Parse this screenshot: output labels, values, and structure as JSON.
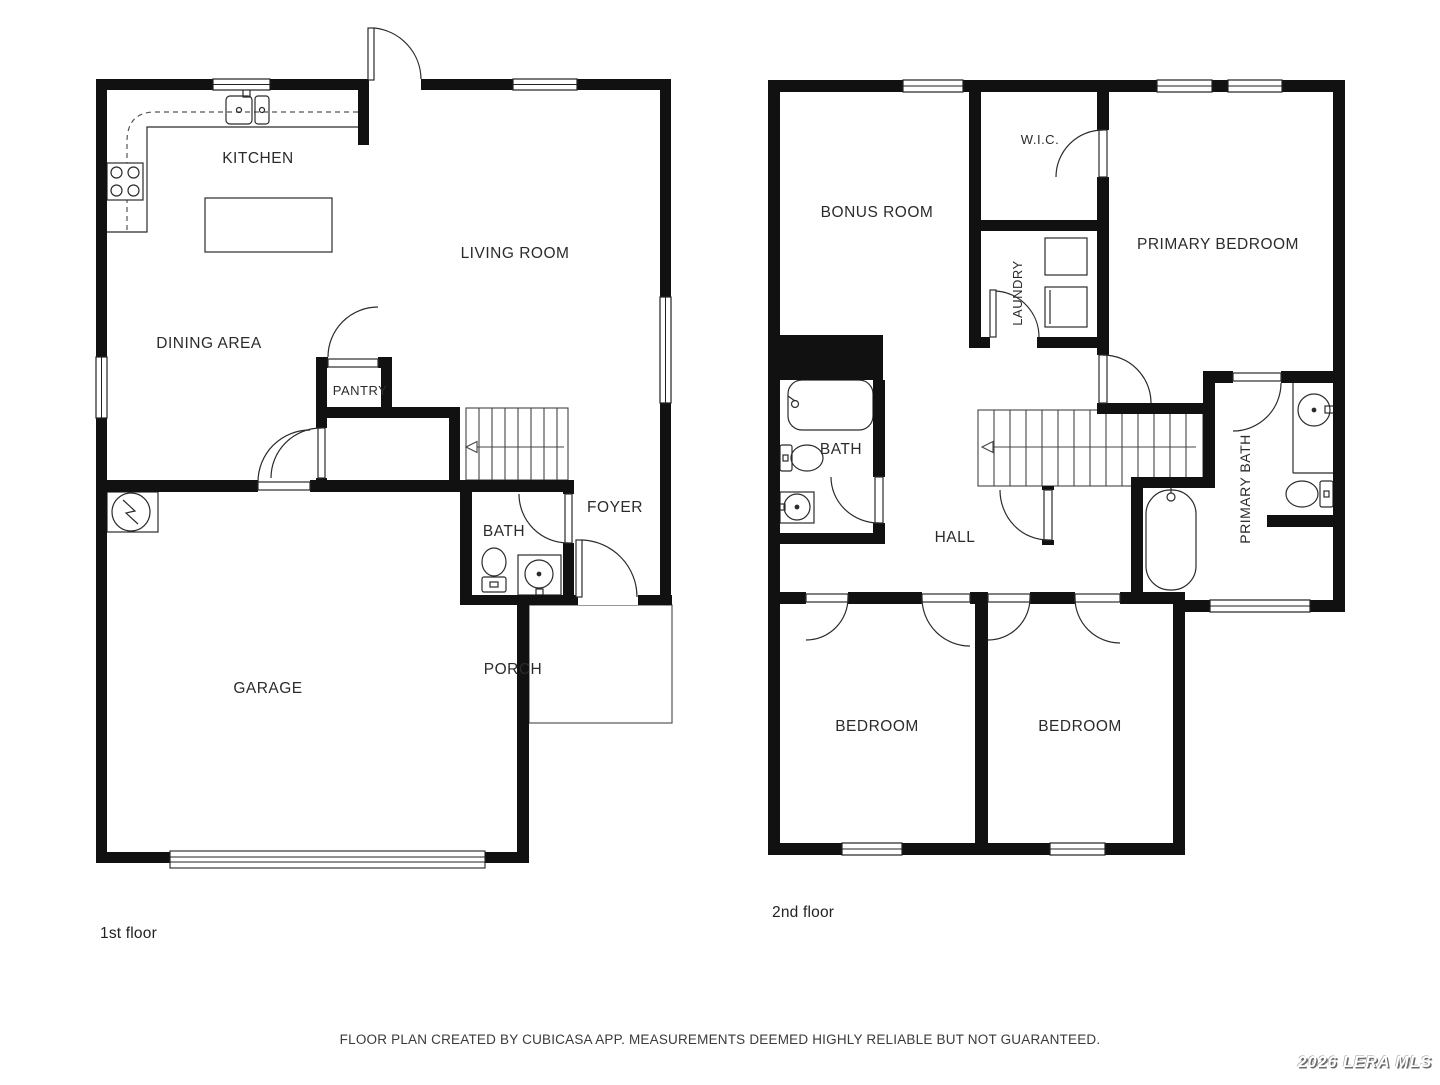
{
  "page": {
    "background": "#ffffff",
    "wall_color": "#111111",
    "accent": "#1a1a1a"
  },
  "footer": {
    "disclaimer": "FLOOR PLAN CREATED BY CUBICASA APP. MEASUREMENTS DEEMED HIGHLY RELIABLE BUT NOT GUARANTEED."
  },
  "watermark": {
    "text": "2026 LERA MLS"
  },
  "floors": [
    {
      "caption": "1st floor",
      "rooms": {
        "kitchen": "KITCHEN",
        "living": "LIVING ROOM",
        "dining": "DINING AREA",
        "pantry": "PANTRY",
        "bath": "BATH",
        "foyer": "FOYER",
        "garage": "GARAGE",
        "porch": "PORCH"
      }
    },
    {
      "caption": "2nd floor",
      "rooms": {
        "bonus": "BONUS ROOM",
        "wic": "W.I.C.",
        "laundry": "LAUNDRY",
        "primary_bedroom": "PRIMARY BEDROOM",
        "bath": "BATH",
        "hall": "HALL",
        "primary_bath": "PRIMARY BATH",
        "bedroom_left": "BEDROOM",
        "bedroom_right": "BEDROOM"
      }
    }
  ]
}
